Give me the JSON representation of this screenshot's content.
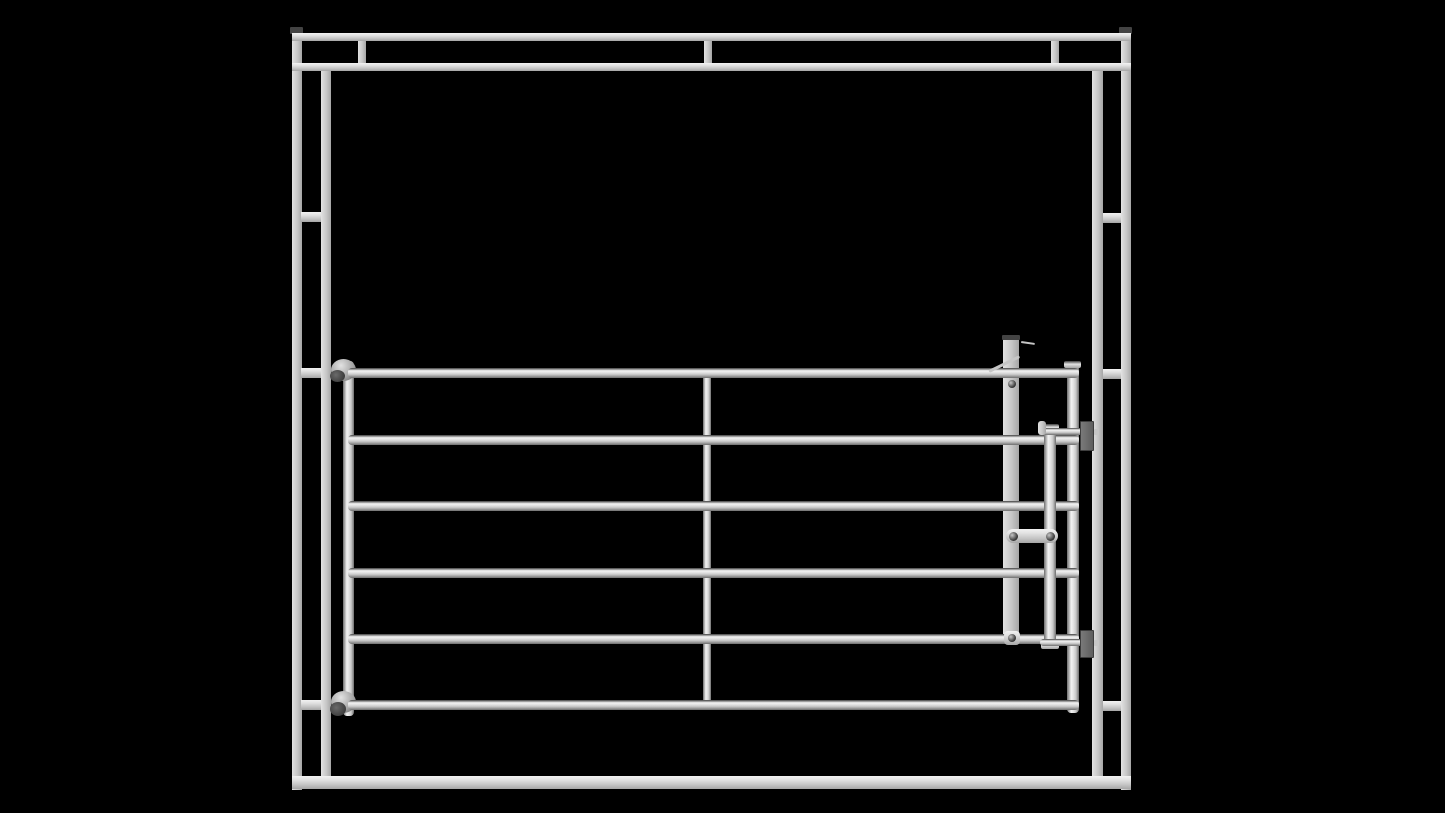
{
  "canvas": {
    "width": 1445,
    "height": 813
  },
  "palette": {
    "background": "#000000",
    "metal-bright": "#f2f2f2",
    "metal-light": "#e2e2e2",
    "metal-mid": "#c6c6c6",
    "metal-dim": "#a6a6a6",
    "metal-shadow": "#6e6e6e",
    "edge-dark": "#3e3e3e",
    "cap-dark": "#434343",
    "plate-gray": "#7a7a7a",
    "bolt-dark": "#383838"
  },
  "scene": {
    "description": "Grayscale 3D render of a 6-rail steel livestock gate with slide latch, mounted in a rectangular steel frame on a black background",
    "members": [
      {
        "name": "frame-outer-post-left",
        "kind": "box-v",
        "x": 292,
        "y": 30,
        "w": 10,
        "h": 760,
        "z": 1
      },
      {
        "name": "frame-outer-post-right",
        "kind": "box-v",
        "x": 1121,
        "y": 30,
        "w": 10,
        "h": 760,
        "z": 1
      },
      {
        "name": "frame-post-cap-left",
        "kind": "cap",
        "x": 290,
        "y": 27,
        "w": 13,
        "h": 7,
        "z": 2
      },
      {
        "name": "frame-post-cap-right",
        "kind": "cap",
        "x": 1119,
        "y": 27,
        "w": 13,
        "h": 7,
        "z": 2
      },
      {
        "name": "frame-top-rail-upper",
        "kind": "box-h",
        "x": 292,
        "y": 33,
        "w": 839,
        "h": 8,
        "z": 2
      },
      {
        "name": "frame-top-rail-lower",
        "kind": "box-h",
        "x": 292,
        "y": 63,
        "w": 839,
        "h": 8,
        "z": 2
      },
      {
        "name": "frame-top-spacer-left",
        "kind": "box-v",
        "x": 358,
        "y": 41,
        "w": 8,
        "h": 22,
        "z": 1
      },
      {
        "name": "frame-top-spacer-middle",
        "kind": "box-v",
        "x": 704,
        "y": 41,
        "w": 8,
        "h": 22,
        "z": 1
      },
      {
        "name": "frame-top-spacer-right",
        "kind": "box-v",
        "x": 1051,
        "y": 41,
        "w": 8,
        "h": 22,
        "z": 1
      },
      {
        "name": "frame-bottom-rail",
        "kind": "box-h",
        "x": 292,
        "y": 776,
        "w": 839,
        "h": 13,
        "z": 2
      },
      {
        "name": "frame-inner-post-left",
        "kind": "box-v",
        "x": 321,
        "y": 71,
        "w": 10,
        "h": 705,
        "z": 1
      },
      {
        "name": "frame-inner-post-right",
        "kind": "box-v",
        "x": 1092,
        "y": 71,
        "w": 11,
        "h": 705,
        "z": 1
      },
      {
        "name": "frame-tie-left-upper",
        "kind": "box-h",
        "x": 301,
        "y": 212,
        "w": 20,
        "h": 10,
        "z": 1
      },
      {
        "name": "frame-tie-left-middle",
        "kind": "box-h",
        "x": 301,
        "y": 368,
        "w": 20,
        "h": 10,
        "z": 1
      },
      {
        "name": "frame-tie-left-lower",
        "kind": "box-h",
        "x": 301,
        "y": 700,
        "w": 20,
        "h": 10,
        "z": 1
      },
      {
        "name": "frame-tie-right-upper",
        "kind": "box-h",
        "x": 1103,
        "y": 213,
        "w": 18,
        "h": 10,
        "z": 1
      },
      {
        "name": "frame-tie-right-middle",
        "kind": "box-h",
        "x": 1103,
        "y": 369,
        "w": 18,
        "h": 10,
        "z": 1
      },
      {
        "name": "frame-tie-right-lower",
        "kind": "box-h",
        "x": 1103,
        "y": 701,
        "w": 18,
        "h": 10,
        "z": 1
      },
      {
        "name": "gate-middle-brace",
        "kind": "tube-v",
        "x": 703,
        "y": 371,
        "w": 8,
        "h": 337,
        "z": 2
      },
      {
        "name": "gate-hinge-stile",
        "kind": "tube-v",
        "x": 343,
        "y": 361,
        "w": 11,
        "h": 355,
        "z": 3
      },
      {
        "name": "gate-latch-stile",
        "kind": "tube-v",
        "x": 1067,
        "y": 363,
        "w": 12,
        "h": 350,
        "z": 3
      },
      {
        "name": "gate-latch-stile-cap",
        "kind": "capbar",
        "x": 1064,
        "y": 361,
        "w": 17,
        "h": 7,
        "z": 5
      },
      {
        "name": "gate-hinge-top-clamp",
        "kind": "hinge",
        "x": 331,
        "y": 359,
        "w": 25,
        "h": 22,
        "z": 3
      },
      {
        "name": "gate-hinge-top-lug",
        "kind": "disc-dark",
        "x": 330,
        "y": 370,
        "w": 15,
        "h": 12,
        "z": 5
      },
      {
        "name": "gate-hinge-bottom-clamp",
        "kind": "hinge",
        "x": 331,
        "y": 691,
        "w": 25,
        "h": 22,
        "z": 3
      },
      {
        "name": "gate-hinge-bottom-lug",
        "kind": "disc-dark",
        "x": 330,
        "y": 702,
        "w": 16,
        "h": 14,
        "z": 5
      },
      {
        "name": "gate-rail-1",
        "kind": "tube-h",
        "x": 348,
        "y": 368,
        "w": 731,
        "h": 10,
        "z": 4
      },
      {
        "name": "gate-rail-2",
        "kind": "tube-h",
        "x": 348,
        "y": 435,
        "w": 731,
        "h": 10,
        "z": 4
      },
      {
        "name": "gate-rail-3",
        "kind": "tube-h",
        "x": 348,
        "y": 501,
        "w": 731,
        "h": 10,
        "z": 4
      },
      {
        "name": "gate-rail-4",
        "kind": "tube-h",
        "x": 348,
        "y": 568,
        "w": 731,
        "h": 10,
        "z": 4
      },
      {
        "name": "gate-rail-5",
        "kind": "tube-h",
        "x": 348,
        "y": 634,
        "w": 731,
        "h": 10,
        "z": 4
      },
      {
        "name": "gate-rail-6",
        "kind": "tube-h",
        "x": 348,
        "y": 700,
        "w": 731,
        "h": 10,
        "z": 4
      },
      {
        "name": "latch-post",
        "kind": "box-v",
        "x": 1003,
        "y": 337,
        "w": 16,
        "h": 307,
        "z": 3
      },
      {
        "name": "latch-post-cap",
        "kind": "cap",
        "x": 1002,
        "y": 335,
        "w": 18,
        "h": 5,
        "z": 5
      },
      {
        "name": "latch-lever-arm",
        "kind": "thin",
        "x": 989,
        "y": 370,
        "w": 34,
        "h": 3,
        "z": 6,
        "rot": -26
      },
      {
        "name": "latch-trigger",
        "kind": "thin",
        "x": 1021,
        "y": 341,
        "w": 14,
        "h": 2,
        "z": 6,
        "rot": 8
      },
      {
        "name": "latch-post-bolt",
        "kind": "bolt",
        "x": 1008,
        "y": 380,
        "w": 8,
        "h": 8,
        "z": 7
      },
      {
        "name": "latch-slide-bar",
        "kind": "tube-v",
        "x": 1044,
        "y": 427,
        "w": 12,
        "h": 220,
        "z": 5
      },
      {
        "name": "latch-slide-cap-top",
        "kind": "capbar",
        "x": 1041,
        "y": 424,
        "w": 18,
        "h": 7,
        "z": 6
      },
      {
        "name": "latch-slide-cap-bottom",
        "kind": "capbar",
        "x": 1041,
        "y": 642,
        "w": 18,
        "h": 7,
        "z": 6
      },
      {
        "name": "latch-link",
        "kind": "box-h",
        "x": 1006,
        "y": 529,
        "w": 52,
        "h": 14,
        "z": 6,
        "r": 7
      },
      {
        "name": "latch-link-bolt-left",
        "kind": "bolt",
        "x": 1009,
        "y": 532,
        "w": 9,
        "h": 9,
        "z": 7
      },
      {
        "name": "latch-link-bolt-right",
        "kind": "bolt",
        "x": 1046,
        "y": 532,
        "w": 9,
        "h": 9,
        "z": 7
      },
      {
        "name": "latch-rod-top",
        "kind": "tube-h",
        "x": 1040,
        "y": 428,
        "w": 54,
        "h": 7,
        "z": 6
      },
      {
        "name": "latch-rod-top-handle",
        "kind": "box-v",
        "x": 1038,
        "y": 421,
        "w": 8,
        "h": 14,
        "z": 6,
        "r": 3
      },
      {
        "name": "latch-keeper-top",
        "kind": "plate",
        "x": 1080,
        "y": 421,
        "w": 14,
        "h": 30,
        "z": 6
      },
      {
        "name": "latch-rod-top-tip",
        "kind": "stub",
        "x": 1094,
        "y": 429,
        "w": 5,
        "h": 6,
        "z": 6
      },
      {
        "name": "latch-rod-bottom",
        "kind": "tube-h",
        "x": 1040,
        "y": 639,
        "w": 54,
        "h": 7,
        "z": 6
      },
      {
        "name": "latch-keeper-bottom",
        "kind": "plate",
        "x": 1080,
        "y": 630,
        "w": 14,
        "h": 28,
        "z": 6
      },
      {
        "name": "latch-rod-bottom-tip",
        "kind": "stub",
        "x": 1094,
        "y": 640,
        "w": 5,
        "h": 6,
        "z": 6
      },
      {
        "name": "latch-weld-collar",
        "kind": "box-h",
        "x": 1004,
        "y": 631,
        "w": 16,
        "h": 14,
        "z": 5,
        "r": 4
      },
      {
        "name": "latch-collar-bolt",
        "kind": "bolt",
        "x": 1008,
        "y": 634,
        "w": 8,
        "h": 8,
        "z": 7
      }
    ]
  }
}
